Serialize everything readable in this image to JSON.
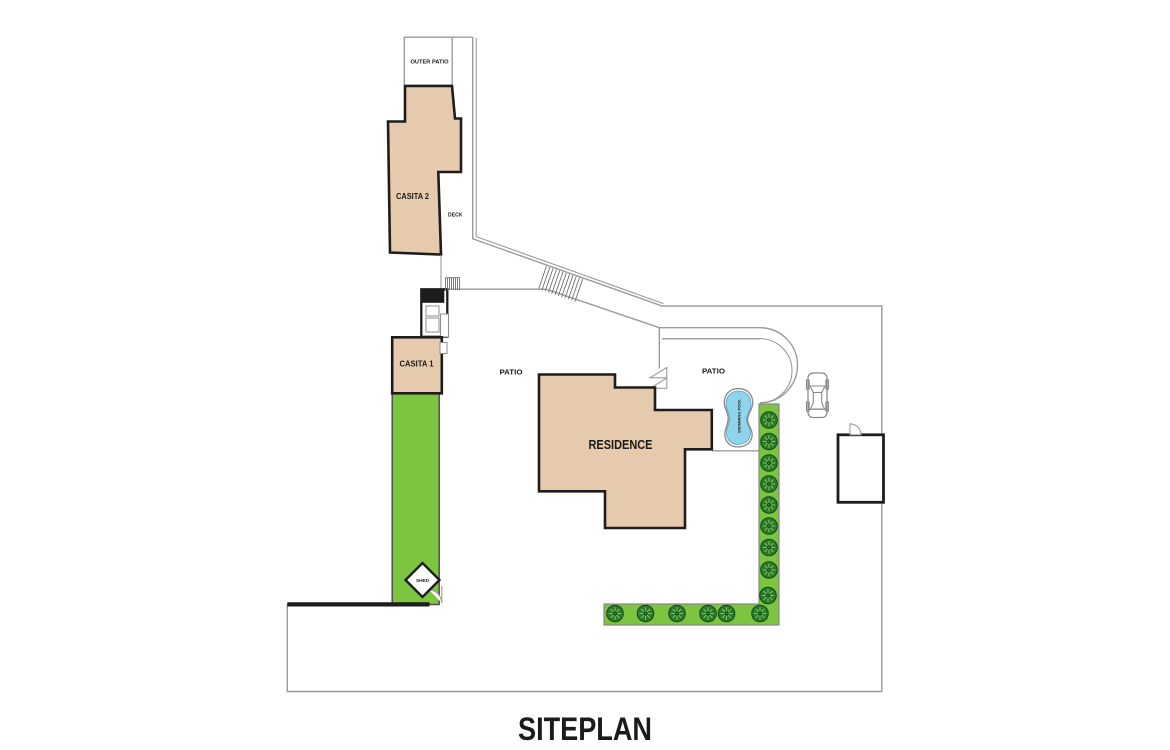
{
  "title": "SITEPLAN",
  "labels": {
    "outer_patio": "OUTER PATIO",
    "casita_2": "CASITA 2",
    "deck": "DECK",
    "casita_1": "CASITA 1",
    "patio_west": "PATIO",
    "patio_east": "PATIO",
    "residence": "RESIDENCE",
    "swimming_pool": "SWIMMING POOL",
    "shed": "SHED"
  },
  "colors": {
    "building_fill": "#e6caae",
    "outline": "#1d1d1d",
    "boundary_gray": "#9b9b9b",
    "lawn_green": "#7dc53e",
    "tree_fill": "#2a7a2e",
    "tree_spokes": "#8fd44f",
    "pool_blue": "#8fd4ea"
  }
}
